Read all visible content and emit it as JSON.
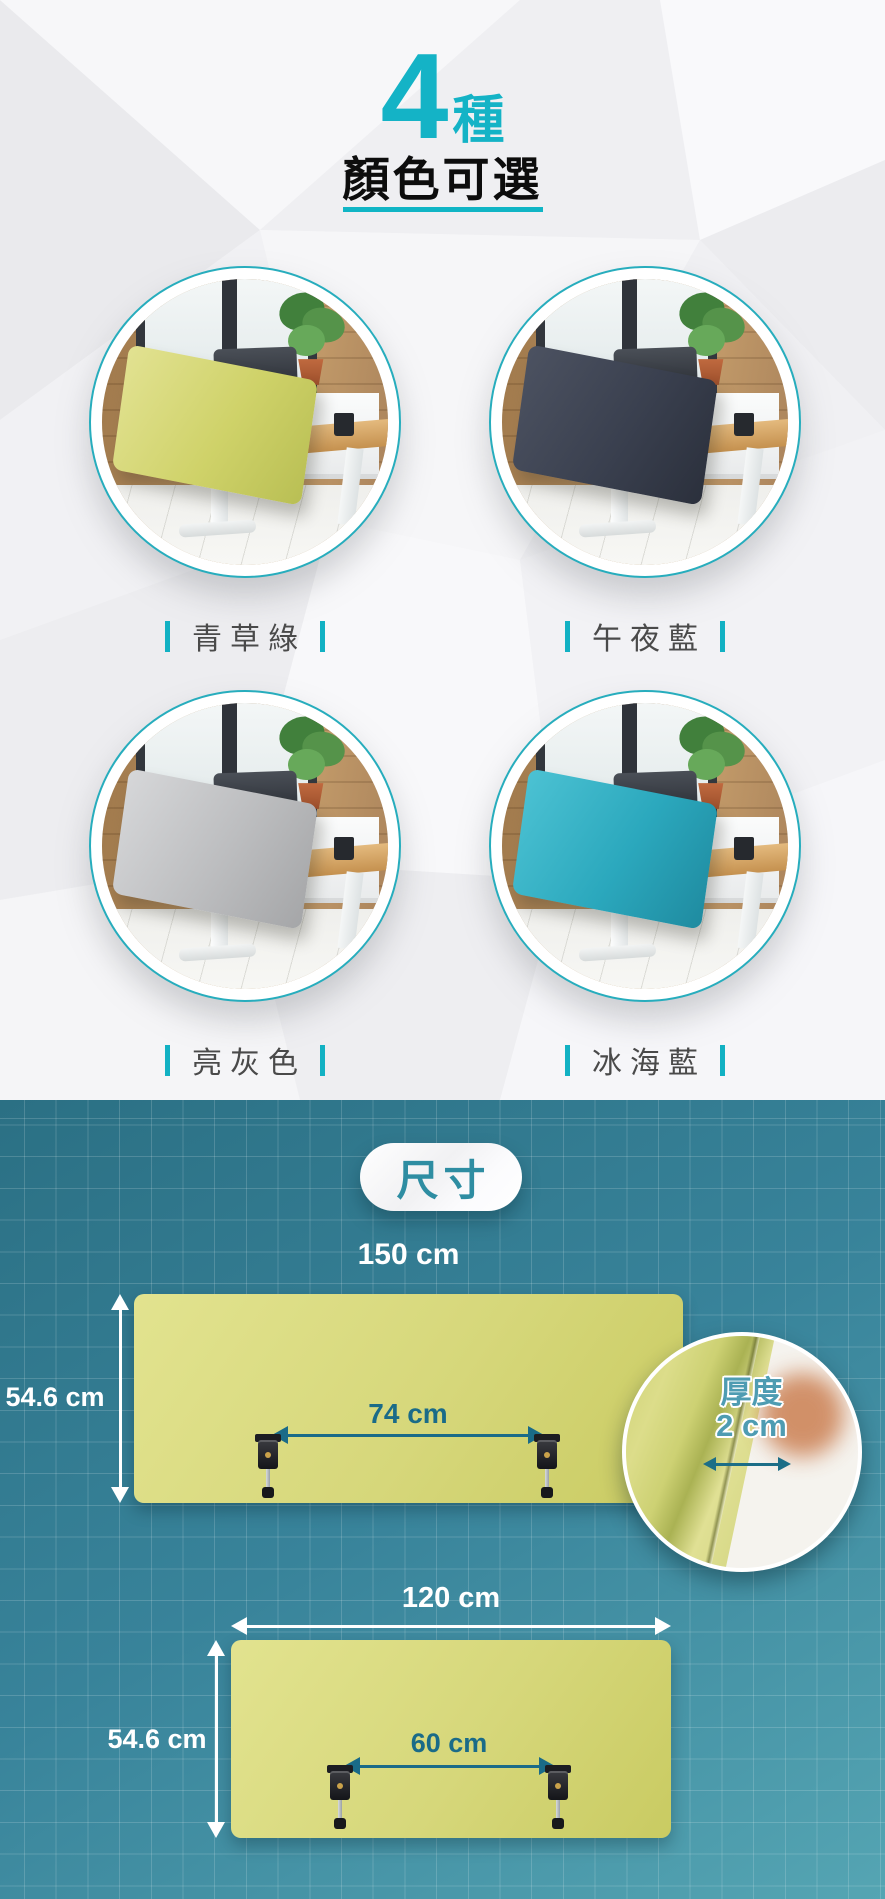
{
  "header": {
    "count": "4",
    "count_suffix": "種",
    "subtitle": "顏色可選",
    "accent_color": "#14b3c6"
  },
  "products": [
    {
      "label": "青草綠",
      "panel_color": "#cfd269",
      "panel_highlight": "#e2e292",
      "panel_shadow": "#b9bf54"
    },
    {
      "label": "午夜藍",
      "panel_color": "#3a404f",
      "panel_highlight": "#4c5261",
      "panel_shadow": "#2b303c"
    },
    {
      "label": "亮灰色",
      "panel_color": "#bcbdbf",
      "panel_highlight": "#d6d7d9",
      "panel_shadow": "#a5a6a8"
    },
    {
      "label": "冰海藍",
      "panel_color": "#2ba8bd",
      "panel_highlight": "#4cc2d3",
      "panel_shadow": "#1f8ba0"
    }
  ],
  "dimensions": {
    "badge_label": "尺寸",
    "background_top": "#2b7084",
    "background_bottom": "#55a5b3",
    "panel_color": "#d6d77a",
    "arrow_white": "#ffffff",
    "arrow_teal": "#1a6b88",
    "large_panel": {
      "width": "150 cm",
      "height": "54.6 cm",
      "clamp_span": "74 cm"
    },
    "thickness": {
      "label": "厚度",
      "value": "2 cm"
    },
    "small_panel": {
      "width": "120 cm",
      "height": "54.6 cm",
      "clamp_span": "60 cm"
    }
  }
}
